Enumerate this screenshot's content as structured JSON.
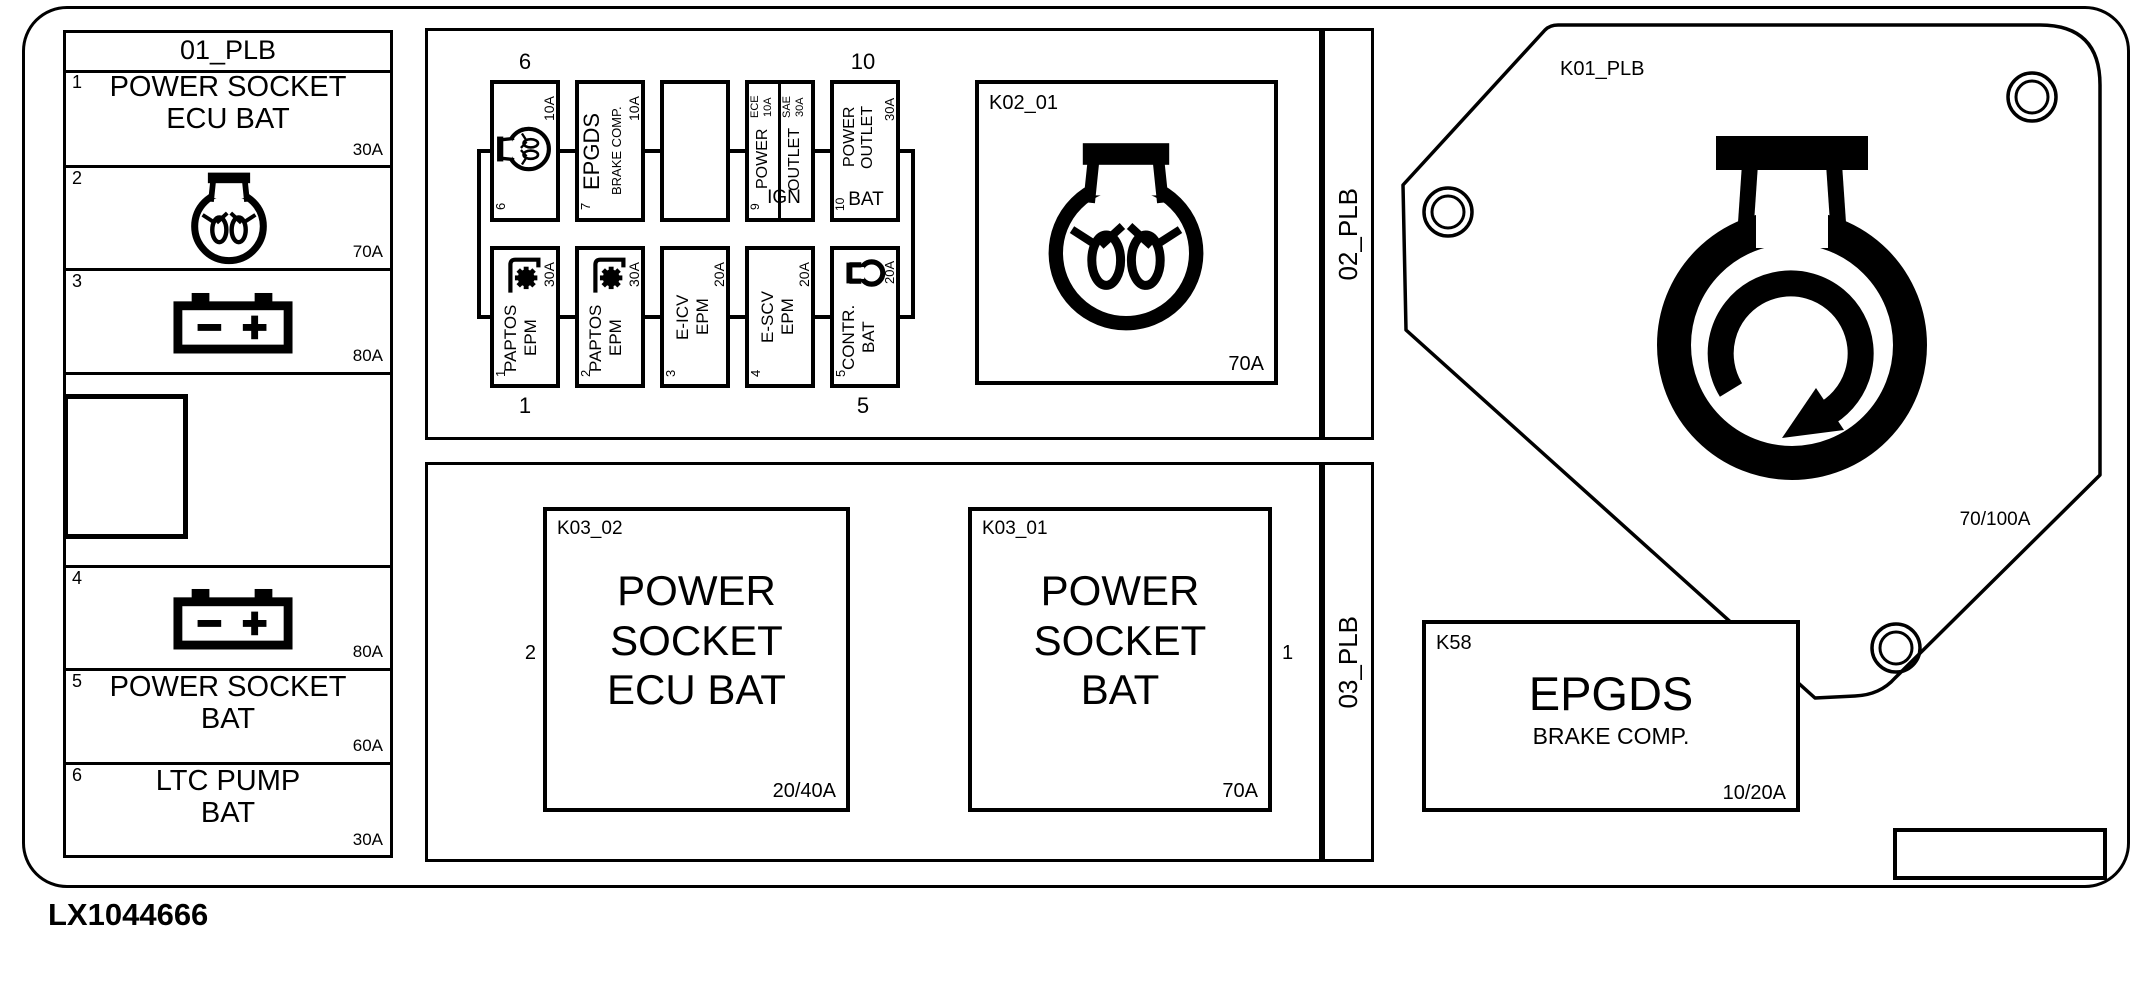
{
  "figure_code": "LX1044666",
  "colors": {
    "ink": "#000000",
    "paper": "#ffffff"
  },
  "panel01": {
    "title": "01_PLB",
    "row1": {
      "num": "1",
      "line1": "POWER SOCKET",
      "line2": "ECU BAT",
      "amp": "30A"
    },
    "row2": {
      "num": "2",
      "amp": "70A",
      "icon": "lamp-icon"
    },
    "row3": {
      "num": "3",
      "amp": "80A",
      "icon": "battery-icon"
    },
    "row4": {
      "num": "4",
      "amp": "80A",
      "icon": "battery-icon"
    },
    "row5": {
      "num": "5",
      "line1": "POWER SOCKET",
      "line2": "BAT",
      "amp": "60A"
    },
    "row6": {
      "num": "6",
      "line1": "LTC PUMP",
      "line2": "BAT",
      "amp": "30A"
    }
  },
  "panel02": {
    "title": "02_PLB",
    "callout_top_left": "6",
    "callout_top_right": "10",
    "callout_bottom_left": "1",
    "callout_bottom_right": "5",
    "fuse6": {
      "num": "6",
      "amp": "10A",
      "icon": "lamp-icon"
    },
    "fuse7": {
      "num": "7",
      "line1": "EPGDS",
      "line2": "BRAKE COMP.",
      "amp": "10A"
    },
    "fuse9": {
      "num": "9",
      "left_head1": "ECE",
      "left_head2": "10A",
      "left_label": "POWER",
      "right_head1": "SAE",
      "right_head2": "30A",
      "right_label": "OUTLET",
      "suffix": "IGN"
    },
    "fuse10": {
      "num": "10",
      "line1": "POWER",
      "line2": "OUTLET",
      "suffix": "BAT",
      "amp": "30A"
    },
    "fuse1": {
      "num": "1",
      "line1": "PAPTOS",
      "line2": "EPM",
      "amp": "30A",
      "icon": "pto-gear-icon"
    },
    "fuse2": {
      "num": "2",
      "line1": "PAPTOS",
      "line2": "EPM",
      "amp": "30A",
      "icon": "pto-gear-icon"
    },
    "fuse3": {
      "num": "3",
      "line1": "E-ICV",
      "line2": "EPM",
      "amp": "20A"
    },
    "fuse4": {
      "num": "4",
      "line1": "E-SCV",
      "line2": "EPM",
      "amp": "20A"
    },
    "fuse5": {
      "num": "5",
      "line1": "CONTR.",
      "line2": "BAT",
      "amp": "20A",
      "icon": "socket-icon"
    },
    "relay": {
      "id": "K02_01",
      "amp": "70A",
      "icon": "lamp-icon"
    }
  },
  "panel03": {
    "title": "03_PLB",
    "k03_02": {
      "id": "K03_02",
      "line1": "POWER",
      "line2": "SOCKET",
      "line3": "ECU BAT",
      "amp": "20/40A",
      "callout": "2"
    },
    "k03_01": {
      "id": "K03_01",
      "line1": "POWER",
      "line2": "SOCKET",
      "line3": "BAT",
      "amp": "70A",
      "callout": "1"
    }
  },
  "k01": {
    "id": "K01_PLB",
    "amp": "70/100A",
    "icon": "power-connector-icon"
  },
  "k58": {
    "id": "K58",
    "line1": "EPGDS",
    "line2": "BRAKE COMP.",
    "amp": "10/20A"
  }
}
